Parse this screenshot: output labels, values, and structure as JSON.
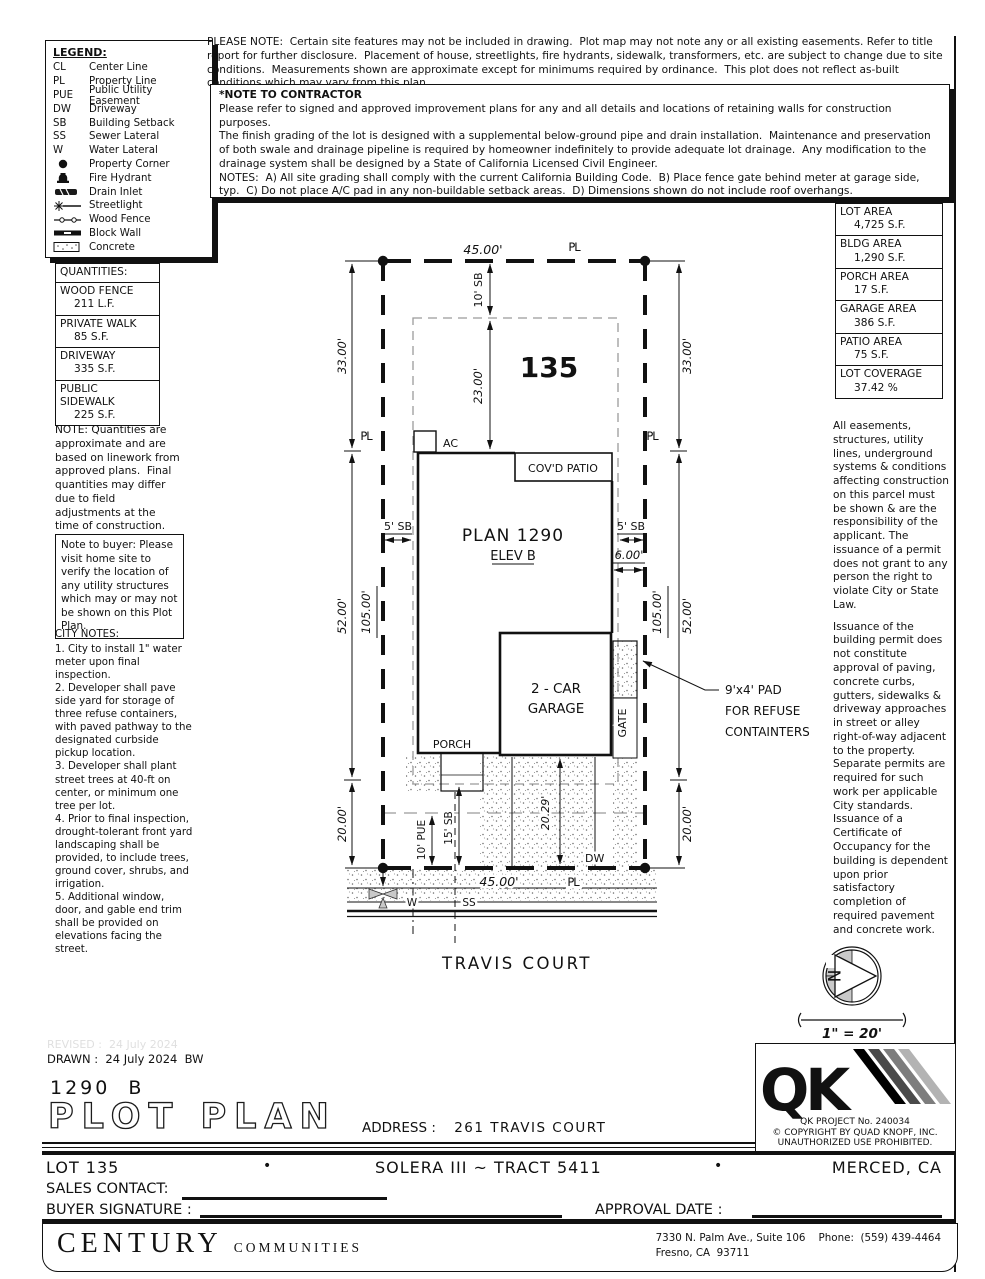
{
  "legend": {
    "title": "LEGEND:",
    "items": [
      {
        "symbol": "CL",
        "label": "Center Line"
      },
      {
        "symbol": "PL",
        "label": "Property Line"
      },
      {
        "symbol": "PUE",
        "label": "Public Utility Easement"
      },
      {
        "symbol": "DW",
        "label": "Driveway"
      },
      {
        "symbol": "SB",
        "label": "Building Setback"
      },
      {
        "symbol": "SS",
        "label": "Sewer Lateral"
      },
      {
        "symbol": "W",
        "label": "Water Lateral"
      },
      {
        "symbol": "",
        "label": "Property Corner"
      },
      {
        "symbol": "",
        "label": "Fire Hydrant"
      },
      {
        "symbol": "",
        "label": "Drain Inlet"
      },
      {
        "symbol": "",
        "label": "Streetlight"
      },
      {
        "symbol": "",
        "label": "Wood Fence"
      },
      {
        "symbol": "",
        "label": "Block Wall"
      },
      {
        "symbol": "",
        "label": "Concrete"
      }
    ]
  },
  "top_note": "PLEASE NOTE:  Certain site features may not be included in drawing.  Plot map may not note any or all existing easements. Refer to title report for further disclosure.  Placement of house, streetlights, fire hydrants, sidewalk, transformers, etc. are subject to change due to site conditions.  Measurements shown are approximate except for minimums required by ordinance.  This plot does not reflect as-built conditions which may vary from this plan.",
  "contractor_note": {
    "title": "*NOTE TO CONTRACTOR",
    "p1": "Please refer to signed and approved improvement plans for any and all details and locations of retaining walls for construction purposes.",
    "p2": "The finish grading of the lot is designed with a supplemental below-ground pipe and drain installation.  Maintenance and preservation of both swale and drainage pipeline is required by homeowner indefinitely to provide adequate lot drainage.  Any modification to the drainage system shall be designed by a State of California Licensed Civil Engineer.",
    "p3": "NOTES:  A) All site grading shall comply with the current California Building Code.  B) Place fence gate behind meter at garage side, typ.  C) Do not place A/C pad in any non-buildable setback areas.  D) Dimensions shown do not include roof overhangs."
  },
  "quantities": {
    "title": "QUANTITIES:",
    "rows": [
      {
        "name": "WOOD FENCE",
        "value": "211 L.F."
      },
      {
        "name": "PRIVATE WALK",
        "value": "85 S.F."
      },
      {
        "name": "DRIVEWAY",
        "value": "335 S.F."
      },
      {
        "name": "PUBLIC SIDEWALK",
        "value": "225 S.F."
      }
    ],
    "note": "NOTE: Quantities are approximate and are based on linework from approved plans.  Final quantities may differ due to field adjustments at the time of construction."
  },
  "buyer_note": "Note to buyer: Please visit home site to verify the location of any utility structures which may or may not be shown on this Plot Plan.",
  "city_notes": {
    "title": "CITY NOTES:",
    "items": [
      "1. City to install 1\" water meter upon final inspection.",
      "2. Developer shall pave side yard for storage of three refuse containers, with paved pathway to the designated curbside pickup location.",
      "3. Developer shall plant street trees at 40-ft on center, or minimum one tree per lot.",
      "4. Prior to final inspection, drought-tolerant front yard landscaping shall be provided, to include trees, ground cover, shrubs, and irrigation.",
      "5. Additional window, door, and gable end trim shall be provided on elevations facing the street."
    ]
  },
  "areas": {
    "rows": [
      {
        "name": "LOT AREA",
        "value": "4,725 S.F."
      },
      {
        "name": "BLDG AREA",
        "value": "1,290 S.F."
      },
      {
        "name": "PORCH AREA",
        "value": "17 S.F."
      },
      {
        "name": "GARAGE AREA",
        "value": "386 S.F."
      },
      {
        "name": "PATIO AREA",
        "value": "75 S.F."
      },
      {
        "name": "LOT COVERAGE",
        "value": "37.42 %"
      }
    ]
  },
  "right_notes": {
    "p1": "All easements, structures, utility lines, underground systems & conditions affecting construction on this parcel must be shown & are the responsibility of the applicant. The issuance of a permit does not grant to any person the right to violate City or State Law.",
    "p2": "Issuance of the building permit does not constitute approval of paving, concrete curbs, gutters, sidewalks & driveway approaches in street or alley right-of-way adjacent to the property. Separate permits are required for such work per applicable City standards. Issuance of a Certificate of Occupancy for the building is dependent upon prior satisfactory completion of required pavement and concrete work."
  },
  "plan": {
    "lot_number": "135",
    "dim_front_top": "45.00'",
    "dim_front_bottom": "45.00'",
    "dim_left_33": "33.00'",
    "dim_left_52": "52.00'",
    "dim_left_20": "20.00'",
    "dim_left_105": "105.00'",
    "dim_right_33": "33.00'",
    "dim_right_52": "52.00'",
    "dim_right_20": "20.00'",
    "dim_right_105": "105.00'",
    "dim_sb_front_top": "10' SB",
    "dim_23": "23.00'",
    "dim_sb_left": "5' SB",
    "dim_sb_right": "5' SB",
    "dim_6": "6.00'",
    "dim_20_29": "20.29'",
    "dim_pue": "10' PUE",
    "dim_sb_15": "15' SB",
    "pl_top": "PL",
    "pl_left": "PL",
    "pl_right": "PL",
    "pl_bottom": "PL",
    "ac_label": "AC",
    "covd_patio": "COV'D PATIO",
    "plan_name": "PLAN 1290",
    "elevation": "ELEV B",
    "garage_line1": "2 - CAR",
    "garage_line2": "GARAGE",
    "gate": "GATE",
    "porch": "PORCH",
    "dw": "DW",
    "w": "W",
    "ss": "SS",
    "refuse_line1": "9'x4' PAD",
    "refuse_line2": "FOR REFUSE",
    "refuse_line3": "CONTAINTERS",
    "street_name": "TRAVIS COURT"
  },
  "north_label": "N",
  "scale_label": "1\" = 20'",
  "titleblock": {
    "revised": "REVISED :  24 July 2024",
    "drawn": "DRAWN :  24 July 2024  BW",
    "plan_code": "1290  B",
    "sheet_title": "PLOT PLAN",
    "address_label": "ADDRESS :",
    "address_value": "261 TRAVIS COURT",
    "lot": "LOT 135",
    "bullet1": "•",
    "tract": "SOLERA III ~ TRACT 5411",
    "bullet2": "•",
    "city": "MERCED, CA",
    "sales_contact": "SALES CONTACT:",
    "buyer_signature": "BUYER SIGNATURE :",
    "approval_date": "APPROVAL DATE :",
    "qk": {
      "mark": "QK",
      "project": "QK PROJECT No. 240034",
      "copy1": "© COPYRIGHT BY QUAD KNOPF, INC.",
      "copy2": "UNAUTHORIZED USE PROHIBITED."
    },
    "builder": {
      "name": "CENTURY",
      "name2": "COMMUNITIES",
      "addr1": "7330 N. Palm Ave., Suite 106    Phone:  (559) 439-4464",
      "addr2": "Fresno, CA  93711"
    }
  }
}
